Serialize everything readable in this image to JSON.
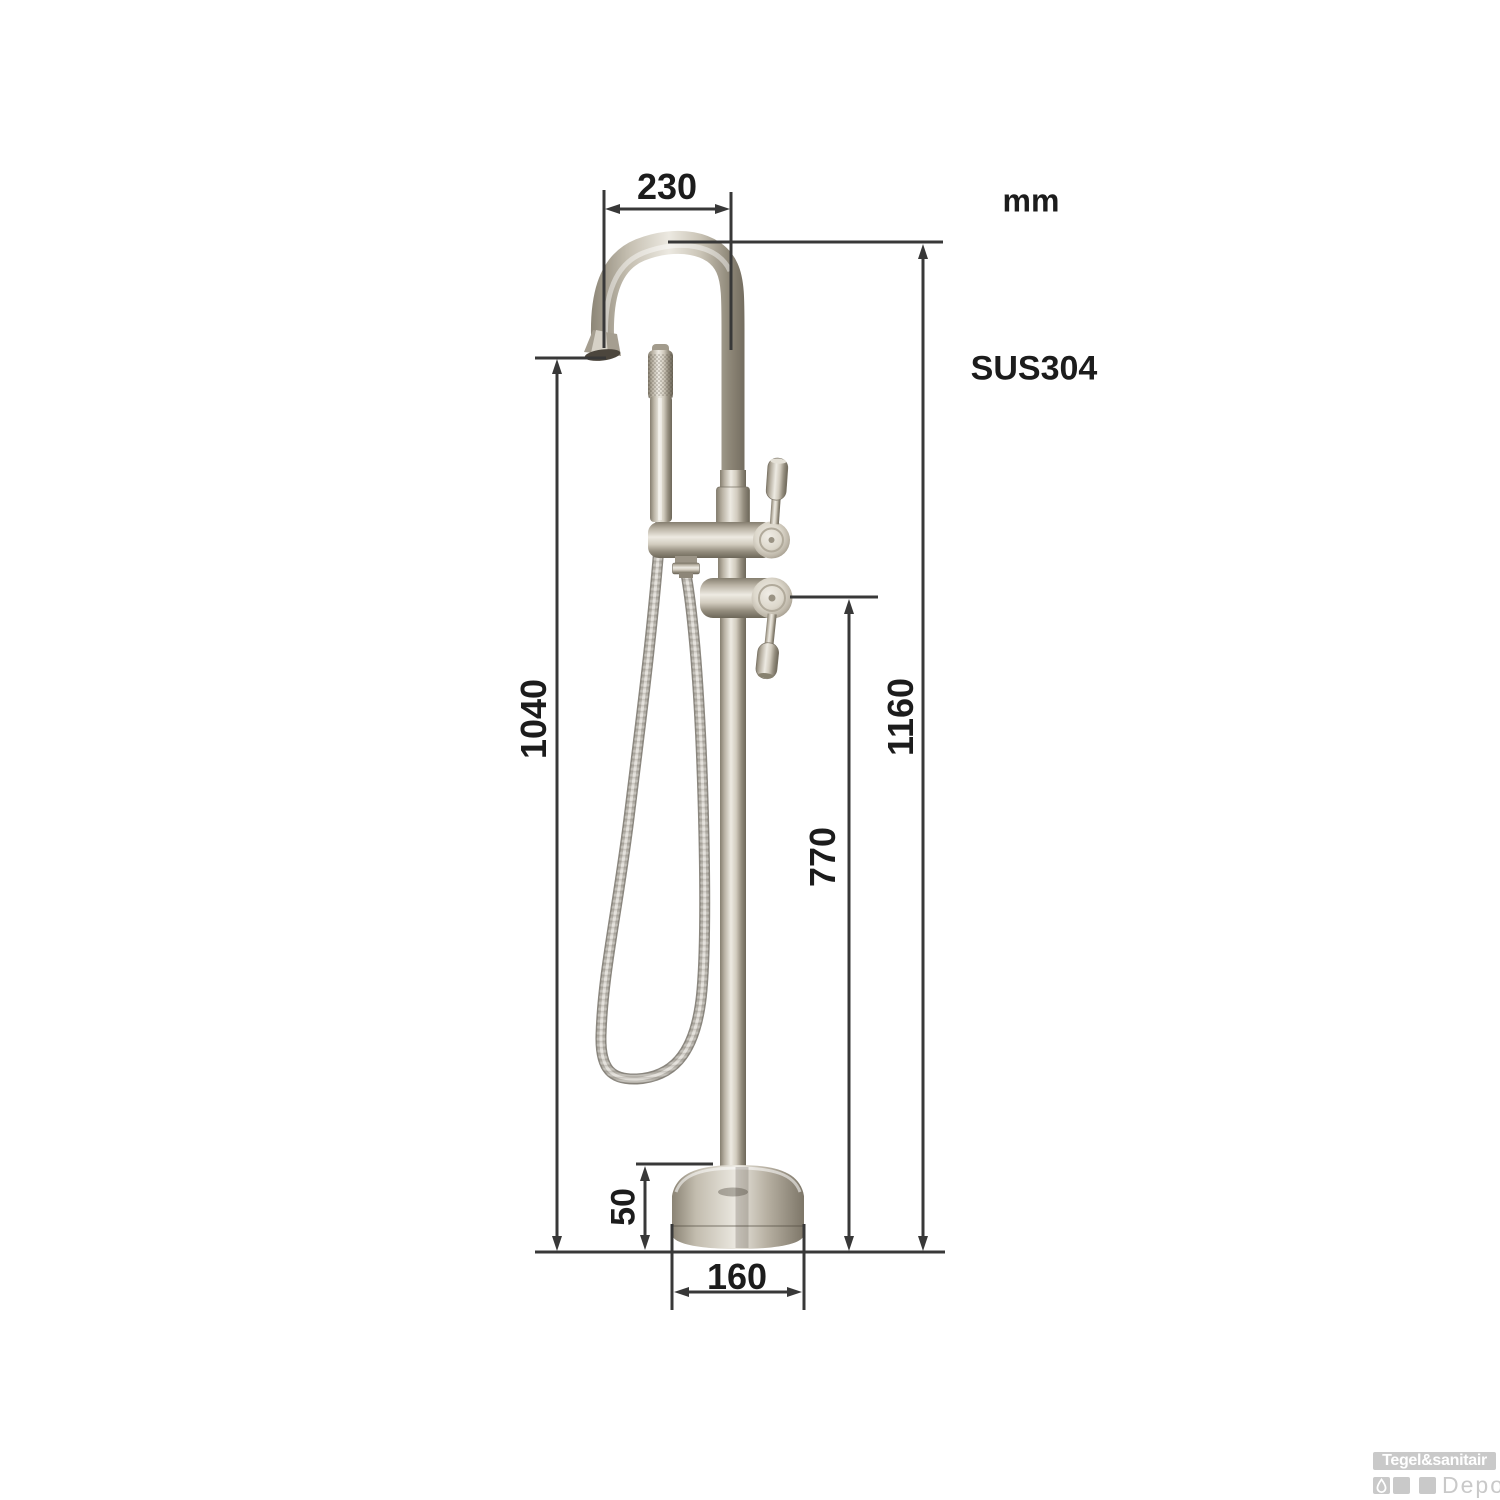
{
  "diagram": {
    "unit_label": "mm",
    "material_label": "SUS304",
    "dimensions": {
      "spout_reach": "230",
      "spout_outlet_height": "1040",
      "total_height": "1160",
      "handle_height": "770",
      "base_height": "50",
      "base_diameter": "160"
    },
    "subject": "freestanding bathtub faucet with hand shower",
    "colors": {
      "dimension_line": "#383838",
      "label_text": "#1c1c1c",
      "metal_mid": "#b3ac9e",
      "metal_light": "#edeae2",
      "metal_dark": "#6d6759",
      "watermark_gray": "#c9c9c9"
    }
  },
  "watermark": {
    "brand": "Tegel&sanitair",
    "sub_brand": "Depot"
  }
}
